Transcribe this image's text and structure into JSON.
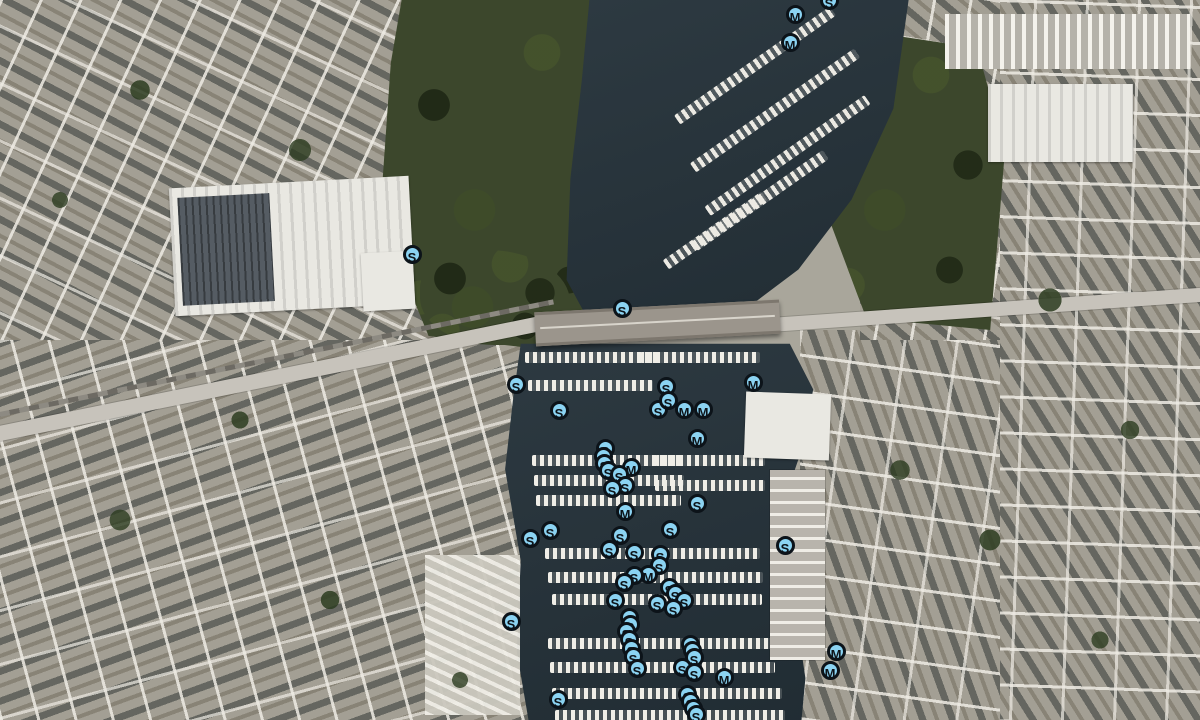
{
  "map": {
    "type": "satellite-aerial",
    "marker_style": {
      "fill": "#8BD3F2",
      "stroke": "#0C1319",
      "text_color": "#0C1319"
    },
    "markers": [
      {
        "label": "S",
        "x": 832,
        "y": 3
      },
      {
        "label": "M",
        "x": 798,
        "y": 17
      },
      {
        "label": "M",
        "x": 793,
        "y": 45
      },
      {
        "label": "S",
        "x": 415,
        "y": 257
      },
      {
        "label": "S",
        "x": 625,
        "y": 311
      },
      {
        "label": "S",
        "x": 519,
        "y": 387
      },
      {
        "label": "S",
        "x": 562,
        "y": 413
      },
      {
        "label": "M",
        "x": 756,
        "y": 385
      },
      {
        "label": "S",
        "x": 669,
        "y": 389
      },
      {
        "label": "S",
        "x": 661,
        "y": 412
      },
      {
        "label": "S",
        "x": 671,
        "y": 403
      },
      {
        "label": "M",
        "x": 687,
        "y": 412
      },
      {
        "label": "M",
        "x": 706,
        "y": 412
      },
      {
        "label": "M",
        "x": 700,
        "y": 441
      },
      {
        "label": "S",
        "x": 608,
        "y": 451
      },
      {
        "label": "S",
        "x": 606,
        "y": 459
      },
      {
        "label": "S",
        "x": 607,
        "y": 466
      },
      {
        "label": "S",
        "x": 611,
        "y": 473
      },
      {
        "label": "M",
        "x": 634,
        "y": 470
      },
      {
        "label": "S",
        "x": 622,
        "y": 477
      },
      {
        "label": "S",
        "x": 628,
        "y": 488
      },
      {
        "label": "S",
        "x": 615,
        "y": 491
      },
      {
        "label": "M",
        "x": 628,
        "y": 514
      },
      {
        "label": "S",
        "x": 700,
        "y": 506
      },
      {
        "label": "S",
        "x": 553,
        "y": 533
      },
      {
        "label": "S",
        "x": 533,
        "y": 541
      },
      {
        "label": "S",
        "x": 788,
        "y": 548
      },
      {
        "label": "S",
        "x": 673,
        "y": 532
      },
      {
        "label": "S",
        "x": 623,
        "y": 538
      },
      {
        "label": "S",
        "x": 612,
        "y": 552
      },
      {
        "label": "S",
        "x": 637,
        "y": 555
      },
      {
        "label": "S",
        "x": 663,
        "y": 557
      },
      {
        "label": "S",
        "x": 662,
        "y": 568
      },
      {
        "label": "M",
        "x": 651,
        "y": 577
      },
      {
        "label": "S",
        "x": 637,
        "y": 578
      },
      {
        "label": "S",
        "x": 627,
        "y": 585
      },
      {
        "label": "S",
        "x": 672,
        "y": 590
      },
      {
        "label": "S",
        "x": 678,
        "y": 596
      },
      {
        "label": "S",
        "x": 687,
        "y": 603
      },
      {
        "label": "S",
        "x": 618,
        "y": 603
      },
      {
        "label": "S",
        "x": 660,
        "y": 606
      },
      {
        "label": "S",
        "x": 676,
        "y": 611
      },
      {
        "label": "S",
        "x": 514,
        "y": 624
      },
      {
        "label": "S",
        "x": 632,
        "y": 620
      },
      {
        "label": "S",
        "x": 633,
        "y": 627
      },
      {
        "label": "S",
        "x": 629,
        "y": 634
      },
      {
        "label": "S",
        "x": 632,
        "y": 642
      },
      {
        "label": "S",
        "x": 634,
        "y": 651
      },
      {
        "label": "S",
        "x": 636,
        "y": 659
      },
      {
        "label": "S",
        "x": 640,
        "y": 671
      },
      {
        "label": "S",
        "x": 693,
        "y": 647
      },
      {
        "label": "S",
        "x": 695,
        "y": 653
      },
      {
        "label": "S",
        "x": 697,
        "y": 660
      },
      {
        "label": "S",
        "x": 685,
        "y": 670
      },
      {
        "label": "S",
        "x": 697,
        "y": 675
      },
      {
        "label": "M",
        "x": 727,
        "y": 680
      },
      {
        "label": "S",
        "x": 690,
        "y": 697
      },
      {
        "label": "S",
        "x": 693,
        "y": 704
      },
      {
        "label": "S",
        "x": 696,
        "y": 711
      },
      {
        "label": "S",
        "x": 699,
        "y": 717
      },
      {
        "label": "M",
        "x": 839,
        "y": 654
      },
      {
        "label": "M",
        "x": 833,
        "y": 673
      },
      {
        "label": "S",
        "x": 561,
        "y": 702
      }
    ]
  }
}
